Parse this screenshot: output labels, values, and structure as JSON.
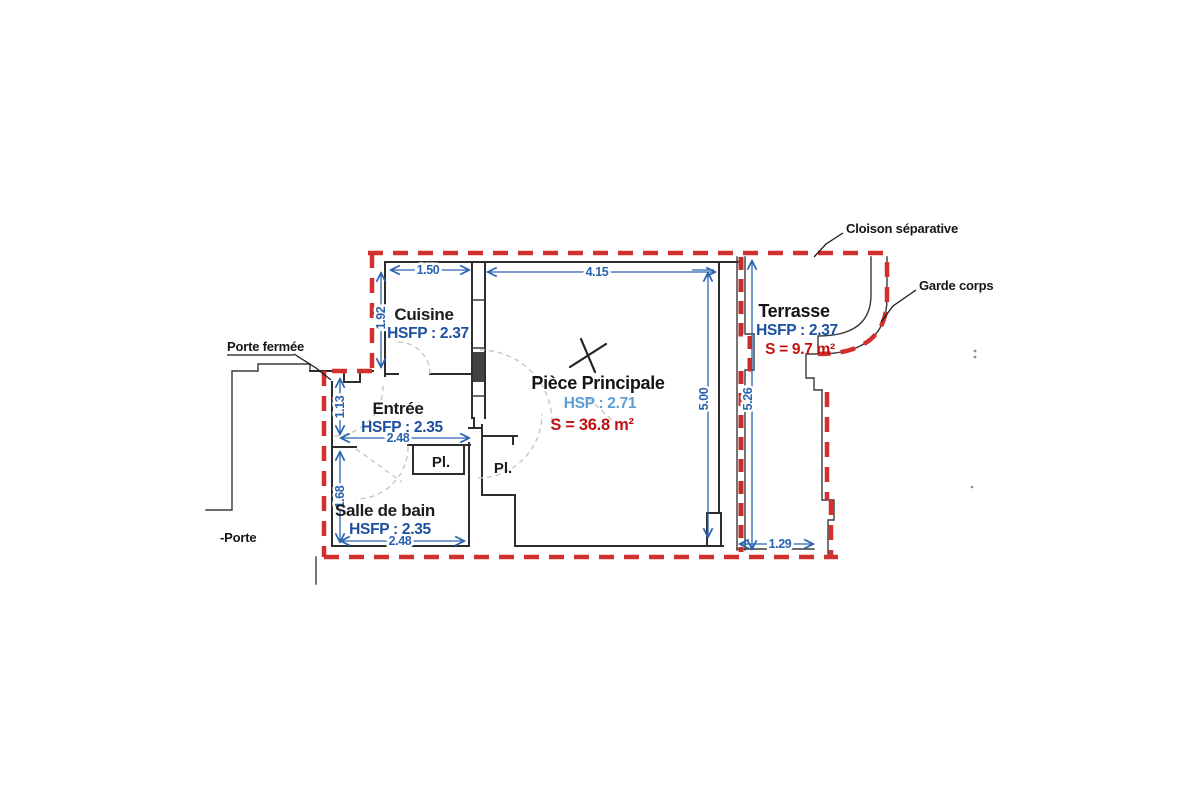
{
  "rooms": {
    "cuisine": {
      "label": "Cuisine",
      "hsfp": "HSFP : 2.37"
    },
    "entree": {
      "label": "Entrée",
      "hsfp": "HSFP : 2.35"
    },
    "salle_de_bain": {
      "label": "Salle de bain",
      "hsfp": "HSFP : 2.35"
    },
    "piece_principale": {
      "label": "Pièce Principale",
      "hsp": "HSP : 2.71",
      "surface": "S = 36.8 m²"
    },
    "terrasse": {
      "label": "Terrasse",
      "hsfp": "HSFP : 2.37",
      "surface": "S = 9.7 m²"
    },
    "placard1": {
      "label": "Pl."
    },
    "placard2": {
      "label": "Pl."
    }
  },
  "dimensions": {
    "cuisine_width": "1.50",
    "piece_width": "4.15",
    "cuisine_height": "1.92",
    "entree_height": "1.13",
    "entree_width": "2.48",
    "bain_height": "1.68",
    "bain_width": "2.48",
    "piece_height": "5.00",
    "terrasse_height": "5.26",
    "terrasse_width": "1.29"
  },
  "annotations": {
    "cloison_separative": "Cloison séparative",
    "garde_corps": "Garde corps",
    "porte_fermee": "Porte fermée",
    "porte": "-Porte"
  },
  "colors": {
    "partition_red": "#d22f2f",
    "dimension_blue": "#2a63b0",
    "hsfp_blue": "#1d4fa1",
    "hsp_light_blue": "#5b9fd6",
    "surface_red": "#c11212",
    "wall_black": "#2d2d2d"
  }
}
